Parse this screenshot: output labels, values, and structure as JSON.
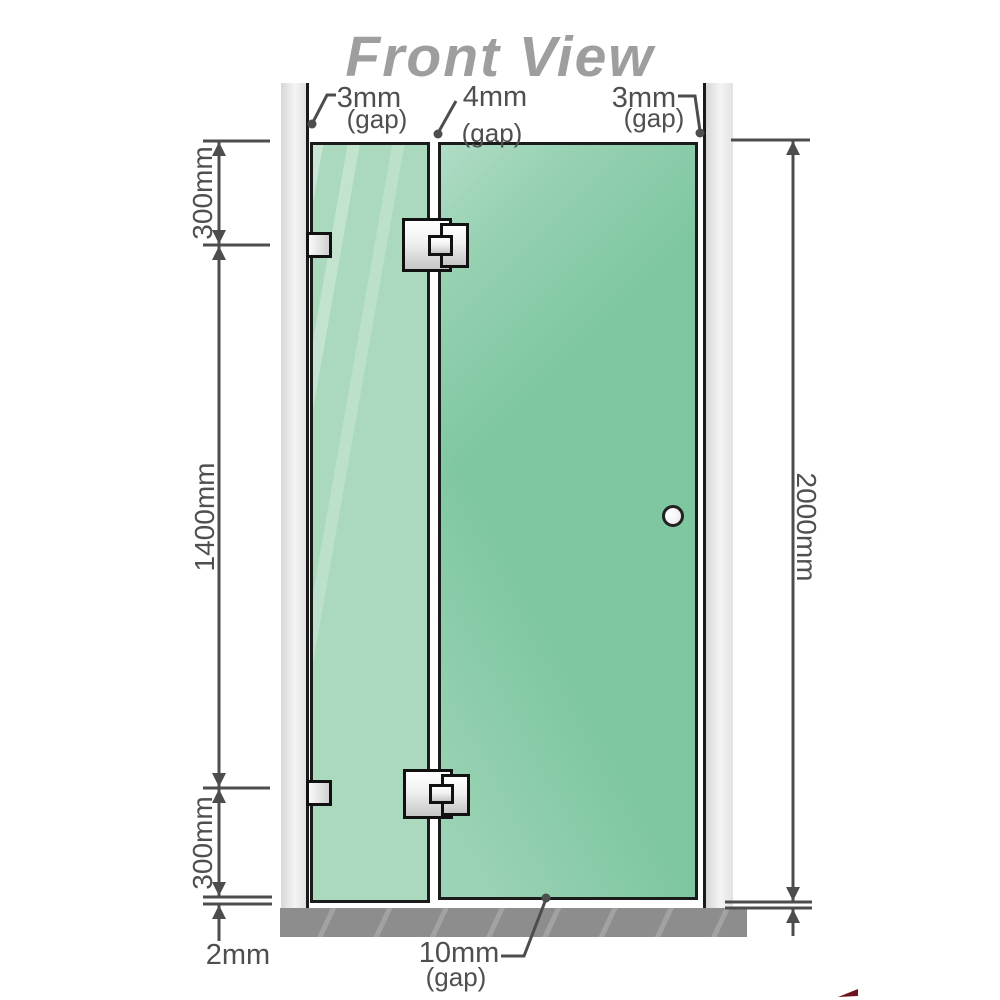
{
  "title": "Front View",
  "labels": {
    "gap_top_left": {
      "value": "3mm",
      "caption": "(gap)"
    },
    "gap_top_middle": {
      "value": "4mm",
      "caption": "(gap)"
    },
    "gap_top_right": {
      "value": "3mm",
      "caption": "(gap)"
    },
    "height_top_section": "300mm",
    "height_middle_section": "1400mm",
    "height_bottom_section": "300mm",
    "floor_clearance": "2mm",
    "total_height": "2000mm",
    "gap_bottom": {
      "value": "10mm",
      "caption": "(gap)"
    }
  },
  "colors": {
    "glass_fixed_panel": "#abd9bd",
    "glass_door_panel": "#7fc7a1",
    "wall_channel": "#e6e6e6",
    "floor": "#8d8d8d",
    "outline": "#1a1a1a",
    "dimension_lines": "#4d4d4d",
    "dimension_text": "#4f4f4f",
    "title_text": "#9e9e9e",
    "hardware_fill": "#e9e9e9",
    "corner_mark": "#6e1420"
  }
}
